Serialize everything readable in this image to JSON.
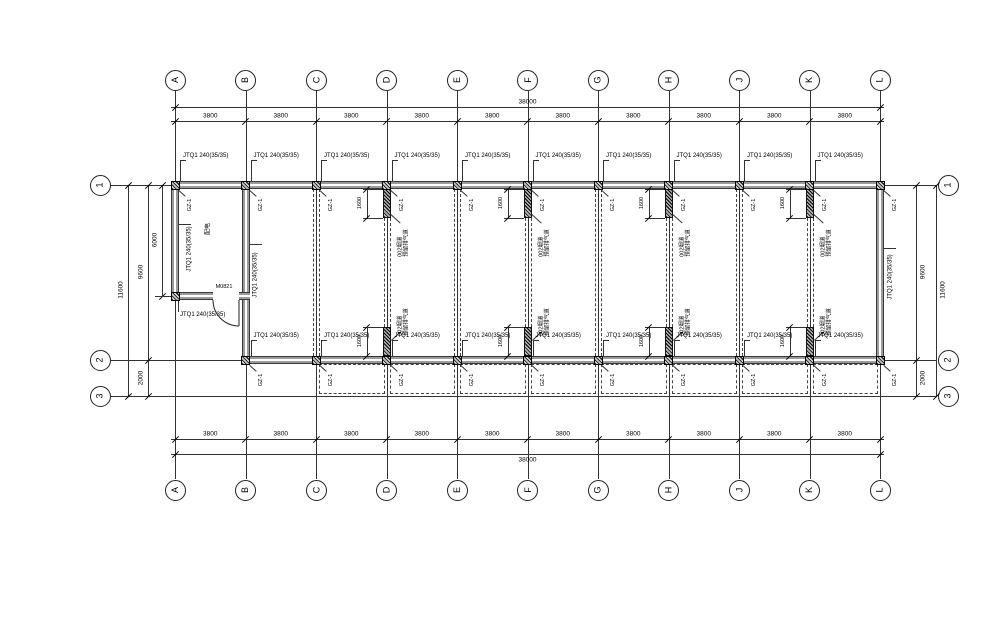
{
  "drawing": {
    "grid": {
      "letters": [
        "A",
        "B",
        "C",
        "D",
        "E",
        "F",
        "G",
        "H",
        "J",
        "K",
        "L"
      ],
      "numbers": [
        "1",
        "2",
        "3"
      ]
    },
    "dimensions": {
      "bay_width": "3800",
      "total_width": "38000",
      "depth_main": "9600",
      "depth_total": "11600",
      "depth_canopy": "2000",
      "room_depth": "6000",
      "stub_length": "1600"
    },
    "annotations": {
      "wall_label": "JTQ1 240(35/35)",
      "column_tag": "GZ-1",
      "door_label": "M0821",
      "room_label": "配电",
      "stub_label_line1": "002烟道",
      "stub_label_line2": "预留排气道"
    },
    "colors": {
      "line": "#333333",
      "wall_gray": "#9b9b9b",
      "background": "#ffffff"
    }
  }
}
